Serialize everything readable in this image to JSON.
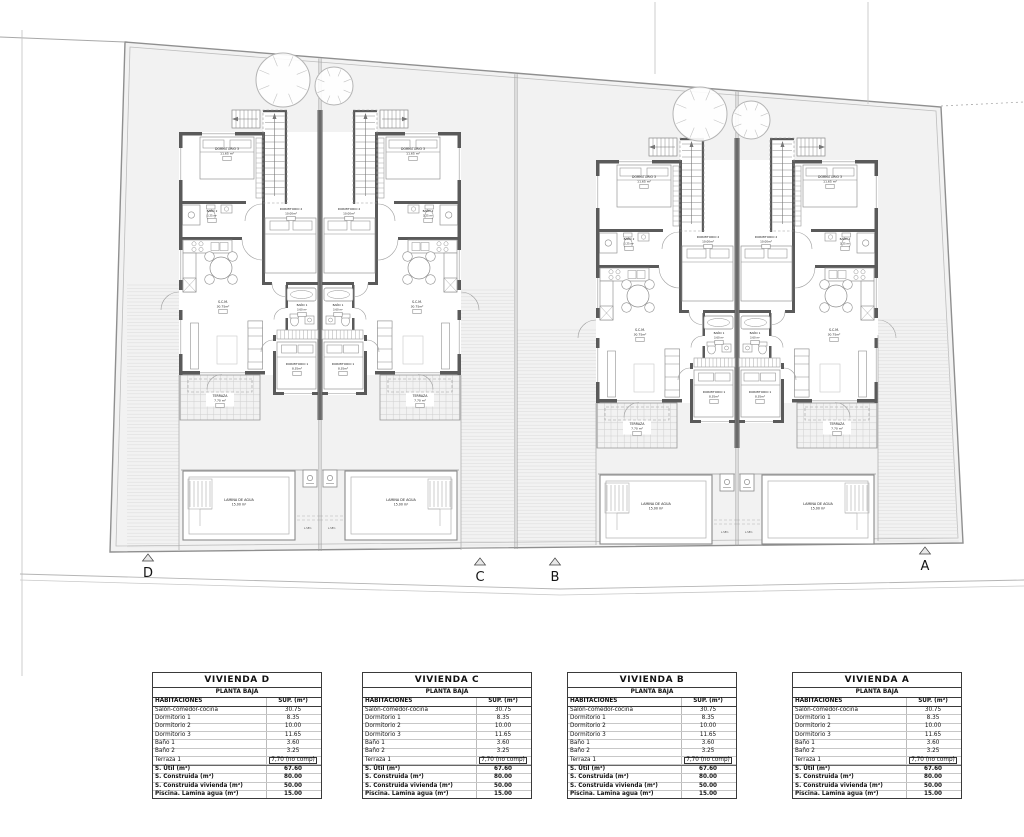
{
  "site": {
    "section_markers": [
      "D",
      "C",
      "B",
      "A"
    ]
  },
  "plan": {
    "rooms": {
      "dormitorio3": {
        "name": "DORMITORIO 3",
        "area": "11.65 m²"
      },
      "banio2": {
        "name": "BAÑO 2",
        "area": "3.25 m²"
      },
      "dormitorio2": {
        "name": "DORMITORIO 2",
        "area": "10.00m²"
      },
      "banio1": {
        "name": "BAÑO 1",
        "area": "3.60 m²"
      },
      "dormitorio1": {
        "name": "DORMITORIO 1",
        "area": "8.35m²"
      },
      "scm": {
        "name": "S.C.M.",
        "area": "30.75m²"
      },
      "terraza": {
        "name": "TERRAZA",
        "area": "7.70 m²"
      },
      "pool": {
        "name": "LAMINA DE AGUA",
        "area": "15.00 m²"
      },
      "lsec": "L.SEC."
    }
  },
  "tables": [
    {
      "title": "VIVIENDA D",
      "subtitle": "PLANTA BAJA",
      "headers": {
        "left": "HABITACIONES",
        "right": "SUP. (m²)"
      },
      "rows": [
        {
          "label": "Salón-comedor-cocina",
          "value": "30.75"
        },
        {
          "label": "Dormitorio 1",
          "value": "8.35"
        },
        {
          "label": "Dormitorio 2",
          "value": "10.00"
        },
        {
          "label": "Dormitorio 3",
          "value": "11.65"
        },
        {
          "label": "Baño 1",
          "value": "3.60"
        },
        {
          "label": "Baño 2",
          "value": "3.25"
        },
        {
          "label": "Terraza 1",
          "value": "7,70 (no comp)",
          "boxed": true
        },
        {
          "label": "S. Útil (m²)",
          "value": "67.60",
          "bold": true,
          "sep": true
        },
        {
          "label": "S. Construida (m²)",
          "value": "80.00",
          "bold": true
        },
        {
          "label": "S. Construida vivienda (m²)",
          "value": "50.00",
          "bold": true
        },
        {
          "label": "Piscina. Lamina agua (m²)",
          "value": "15.00",
          "bold": true
        }
      ]
    },
    {
      "title": "VIVIENDA C",
      "subtitle": "PLANTA BAJA",
      "headers": {
        "left": "HABITACIONES",
        "right": "SUP. (m²)"
      },
      "rows": [
        {
          "label": "Salón-comedor-cocina",
          "value": "30.75"
        },
        {
          "label": "Dormitorio 1",
          "value": "8.35"
        },
        {
          "label": "Dormitorio 2",
          "value": "10.00"
        },
        {
          "label": "Dormitorio 3",
          "value": "11.65"
        },
        {
          "label": "Baño 1",
          "value": "3.60"
        },
        {
          "label": "Baño 2",
          "value": "3.25"
        },
        {
          "label": "Terraza 1",
          "value": "7,70 (no comp)",
          "boxed": true
        },
        {
          "label": "S. Útil (m²)",
          "value": "67.60",
          "bold": true,
          "sep": true
        },
        {
          "label": "S. Construida (m²)",
          "value": "80.00",
          "bold": true
        },
        {
          "label": "S. Construida vivienda (m²)",
          "value": "50.00",
          "bold": true
        },
        {
          "label": "Piscina. Lamina agua (m²)",
          "value": "15.00",
          "bold": true
        }
      ]
    },
    {
      "title": "VIVIENDA B",
      "subtitle": "PLANTA BAJA",
      "headers": {
        "left": "HABITACIONES",
        "right": "SUP. (m²)"
      },
      "rows": [
        {
          "label": "Salón-comedor-cocina",
          "value": "30.75"
        },
        {
          "label": "Dormitorio 1",
          "value": "8.35"
        },
        {
          "label": "Dormitorio 2",
          "value": "10.00"
        },
        {
          "label": "Dormitorio 3",
          "value": "11.65"
        },
        {
          "label": "Baño 1",
          "value": "3.60"
        },
        {
          "label": "Baño 2",
          "value": "3.25"
        },
        {
          "label": "Terraza 1",
          "value": "7,70 (no comp)",
          "boxed": true
        },
        {
          "label": "S. Útil (m²)",
          "value": "67.60",
          "bold": true,
          "sep": true
        },
        {
          "label": "S. Construida (m²)",
          "value": "80.00",
          "bold": true
        },
        {
          "label": "S. Construida vivienda (m²)",
          "value": "50.00",
          "bold": true
        },
        {
          "label": "Piscina. Lamina agua (m²)",
          "value": "15.00",
          "bold": true
        }
      ]
    },
    {
      "title": "VIVIENDA A",
      "subtitle": "PLANTA BAJA",
      "headers": {
        "left": "HABITACIONES",
        "right": "SUP. (m²)"
      },
      "rows": [
        {
          "label": "Salón-comedor-cocina",
          "value": "30.75"
        },
        {
          "label": "Dormitorio 1",
          "value": "8.35"
        },
        {
          "label": "Dormitorio 2",
          "value": "10.00"
        },
        {
          "label": "Dormitorio 3",
          "value": "11.65"
        },
        {
          "label": "Baño 1",
          "value": "3.60"
        },
        {
          "label": "Baño 2",
          "value": "3.25"
        },
        {
          "label": "Terraza 1",
          "value": "7,70 (no comp)",
          "boxed": true
        },
        {
          "label": "S. Útil (m²)",
          "value": "67.60",
          "bold": true,
          "sep": true
        },
        {
          "label": "S. Construida (m²)",
          "value": "80.00",
          "bold": true
        },
        {
          "label": "S. Construida vivienda (m²)",
          "value": "50.00",
          "bold": true
        },
        {
          "label": "Piscina. Lamina agua (m²)",
          "value": "15.00",
          "bold": true
        }
      ]
    }
  ]
}
